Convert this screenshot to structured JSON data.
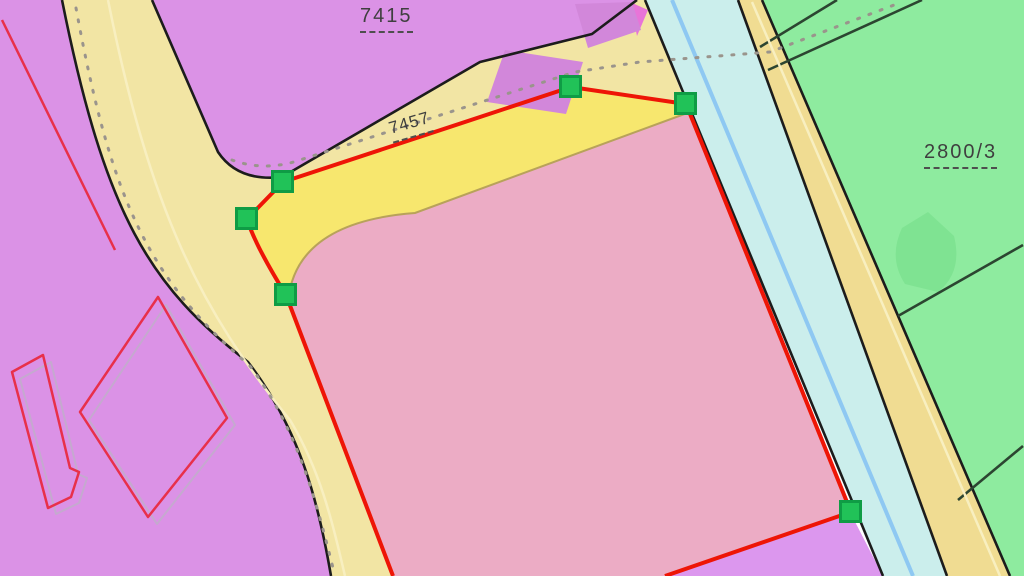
{
  "map": {
    "parcels": [
      {
        "label": "7415"
      },
      {
        "label": "7457"
      },
      {
        "label": "2800/3"
      }
    ],
    "editing": {
      "outline_color": "#ee1506",
      "vertex_handles": [
        {
          "x": 286,
          "y": 295
        },
        {
          "x": 247,
          "y": 219
        },
        {
          "x": 283,
          "y": 182
        },
        {
          "x": 571,
          "y": 87
        },
        {
          "x": 686,
          "y": 104
        },
        {
          "x": 851,
          "y": 512
        }
      ]
    }
  },
  "colors": {
    "purple": "#db92e6",
    "purpleBR": "#dc97ee",
    "buildingDark": "#d287da",
    "magenta": "#e874d8",
    "roadYellow": "#f2e5a4",
    "rightRoad": "#f0dc92",
    "wedgeYellow": "#f7e76e",
    "pink": "#ecacc5",
    "stream": "#cbeeec",
    "streamLine": "#8ec8f2",
    "green": "#8eeb9f",
    "greenBlob": "#7fe392",
    "line": "#1c1c1c",
    "greenLine": "#2c4531",
    "oliveEdge": "#b8a25a",
    "dots": "#9a948c",
    "roadStripe": "#f8efc0",
    "red": "#ee1506",
    "redThin": "#e8304a",
    "grayOutline": "#c5a9cf",
    "handleFill": "#21c258",
    "handleStroke": "#0f9c45",
    "labelColor": "#3f3f3f"
  }
}
